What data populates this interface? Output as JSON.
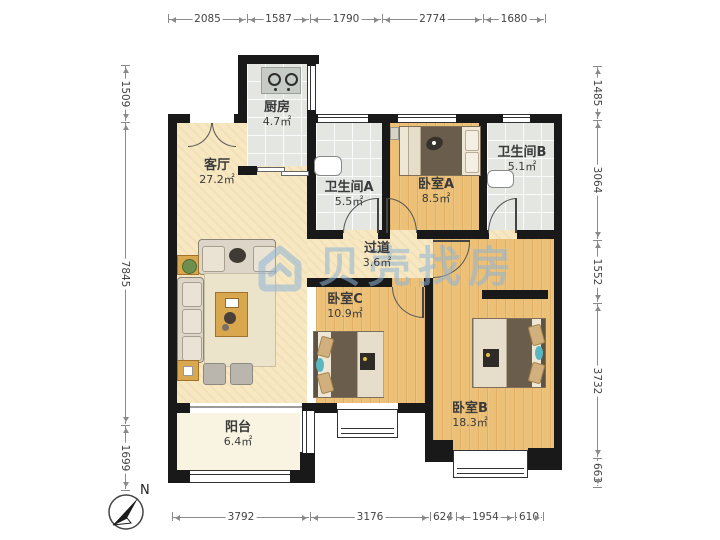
{
  "watermark": {
    "text": "贝壳找房"
  },
  "compass": {
    "label": "N"
  },
  "rooms": {
    "kitchen": {
      "name": "厨房",
      "area": "4.7㎡"
    },
    "living": {
      "name": "客厅",
      "area": "27.2㎡"
    },
    "bathA": {
      "name": "卫生间A",
      "area": "5.5㎡"
    },
    "bedA": {
      "name": "卧室A",
      "area": "8.5㎡"
    },
    "bathB": {
      "name": "卫生间B",
      "area": "5.1㎡"
    },
    "hallway": {
      "name": "过道",
      "area": "3.6㎡"
    },
    "bedC": {
      "name": "卧室C",
      "area": "10.9㎡"
    },
    "bedB": {
      "name": "卧室B",
      "area": "18.3㎡"
    },
    "balcony": {
      "name": "阳台",
      "area": "6.4㎡"
    }
  },
  "dimensions": {
    "top": [
      "2085",
      "1587",
      "1790",
      "2774",
      "1680"
    ],
    "left": [
      "1509",
      "7845",
      "1699"
    ],
    "right": [
      "1485",
      "3064",
      "1552",
      "3732",
      "663"
    ],
    "bottom": [
      "3792",
      "3176",
      "624",
      "1954",
      "610"
    ]
  },
  "colors": {
    "wall": "#191919",
    "wood_floor": "#ecc077",
    "beige_floor": "#f7e8c2",
    "tile_floor": "#e4e6e1",
    "balcony_floor": "#f9f4e1",
    "watermark_blue": "#8fb4d6"
  }
}
